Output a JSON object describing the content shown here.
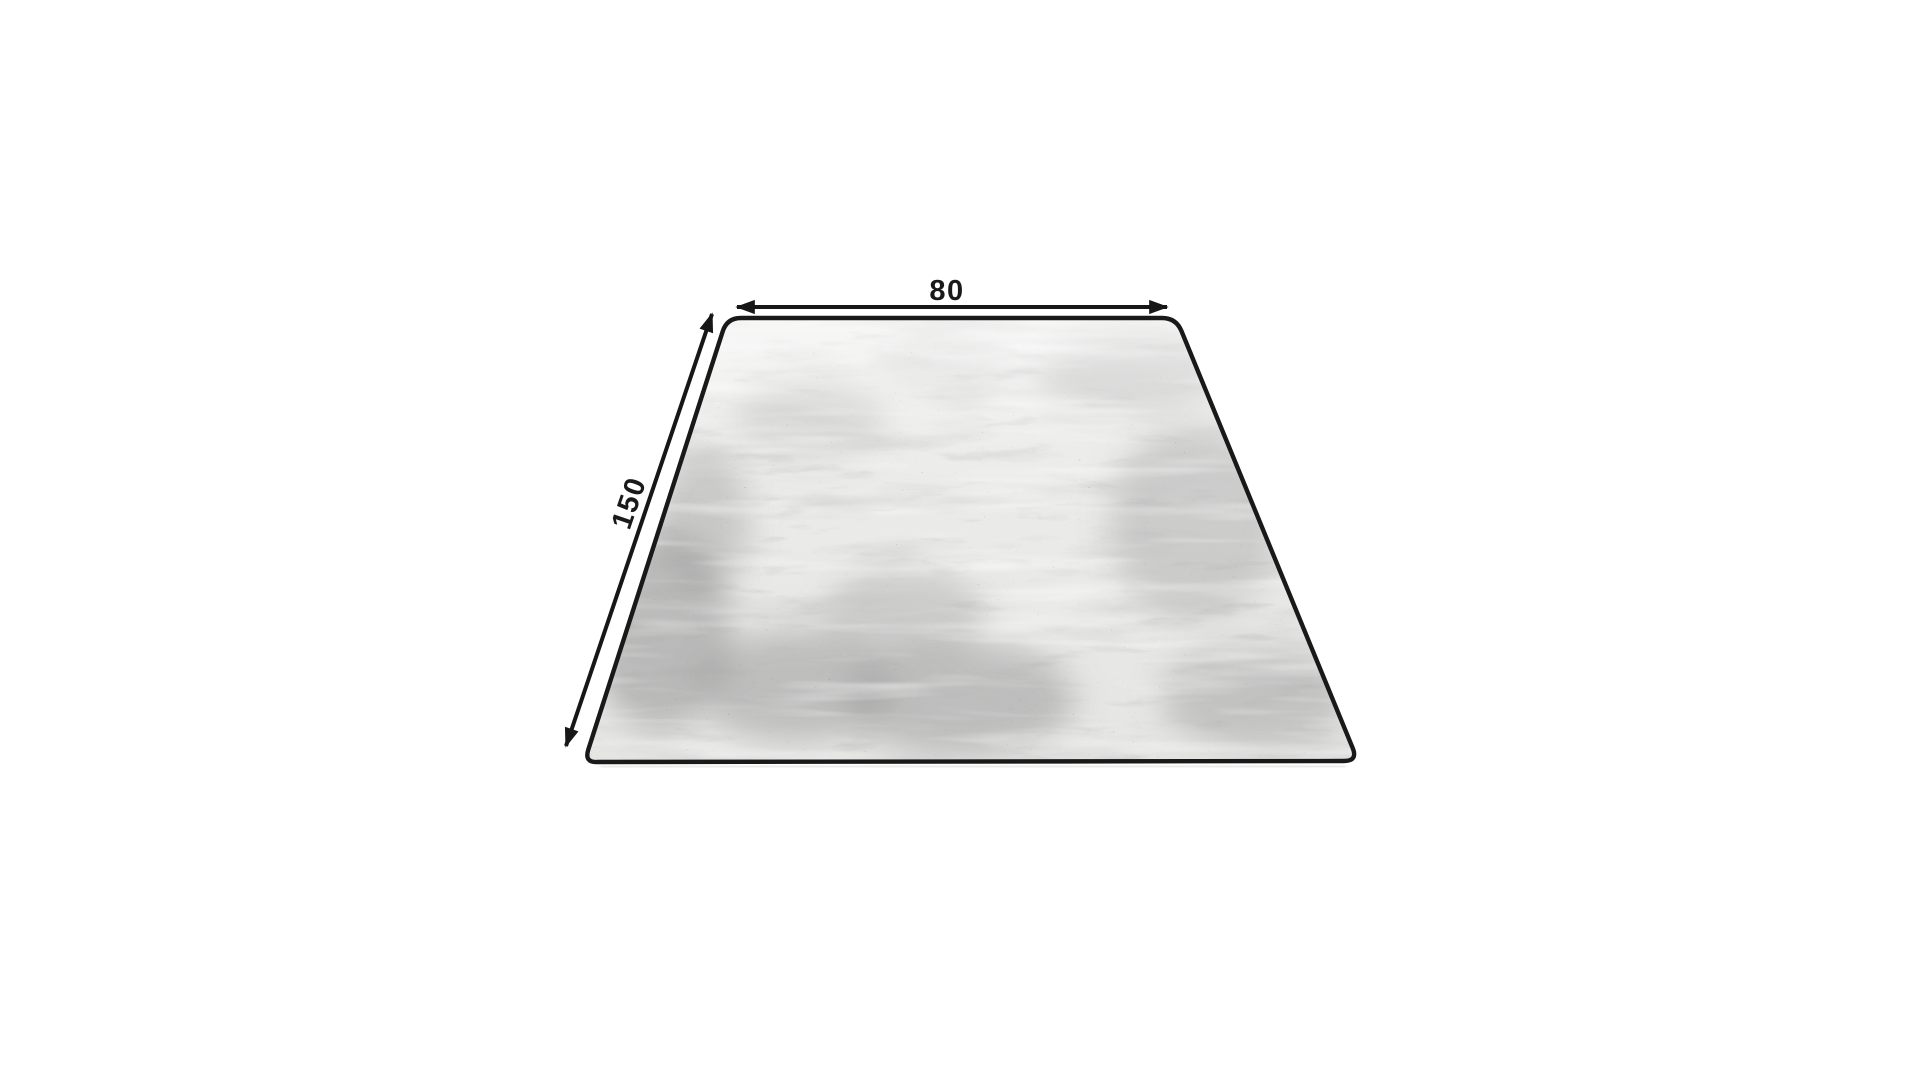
{
  "diagram": {
    "type": "rug-size-dimension-diagram",
    "subject": "distressed gray rug, perspective top view",
    "width_label": "80",
    "length_label": "150",
    "colors": {
      "background": "#ffffff",
      "line": "#171717",
      "rug_border": "#191919",
      "rug_base": "#eaeae9",
      "rug_mottle_gray": "#8c8c8c",
      "shadow": "#dcdcdc"
    }
  }
}
